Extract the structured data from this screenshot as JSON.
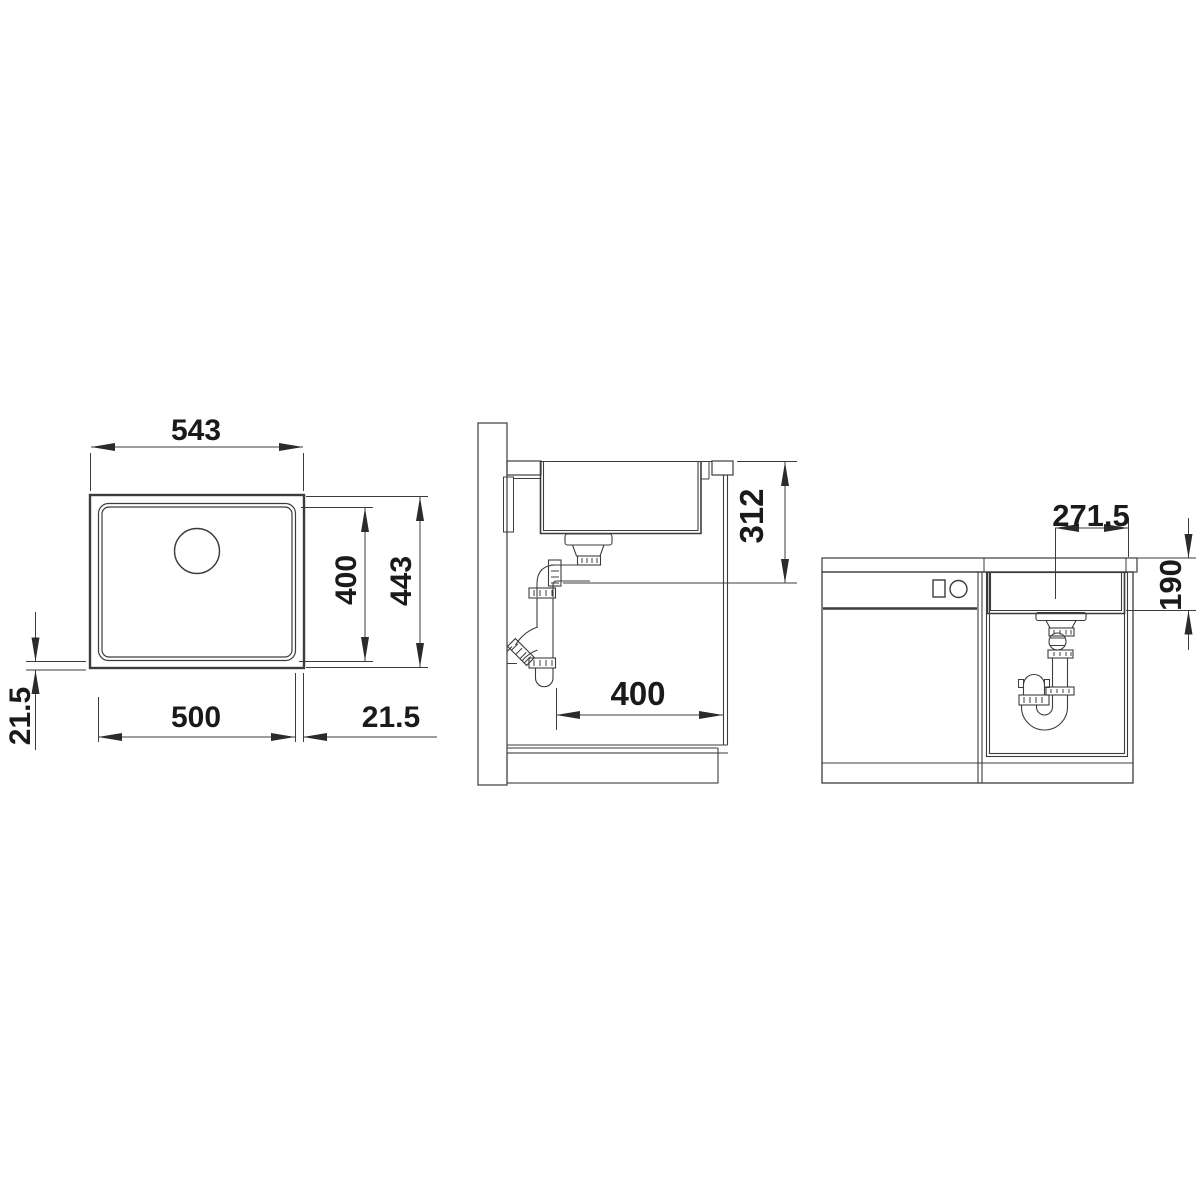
{
  "drawing": {
    "colors": {
      "background": "#ffffff",
      "line": "#3c3c3c",
      "hatch": "#4a4a4a",
      "text": "#1a1a1a"
    },
    "views": {
      "top_view": {
        "dims": {
          "total_width": "543",
          "bowl_length": "400",
          "total_depth": "443",
          "bowl_width": "500",
          "rim_offset_right": "21.5",
          "rim_offset_bottom": "21.5"
        }
      },
      "section_view": {
        "dims": {
          "drain_height": "312",
          "clearance_depth": "400"
        }
      },
      "front_view": {
        "dims": {
          "drain_center_offset": "271.5",
          "bowl_depth": "190"
        }
      }
    }
  }
}
